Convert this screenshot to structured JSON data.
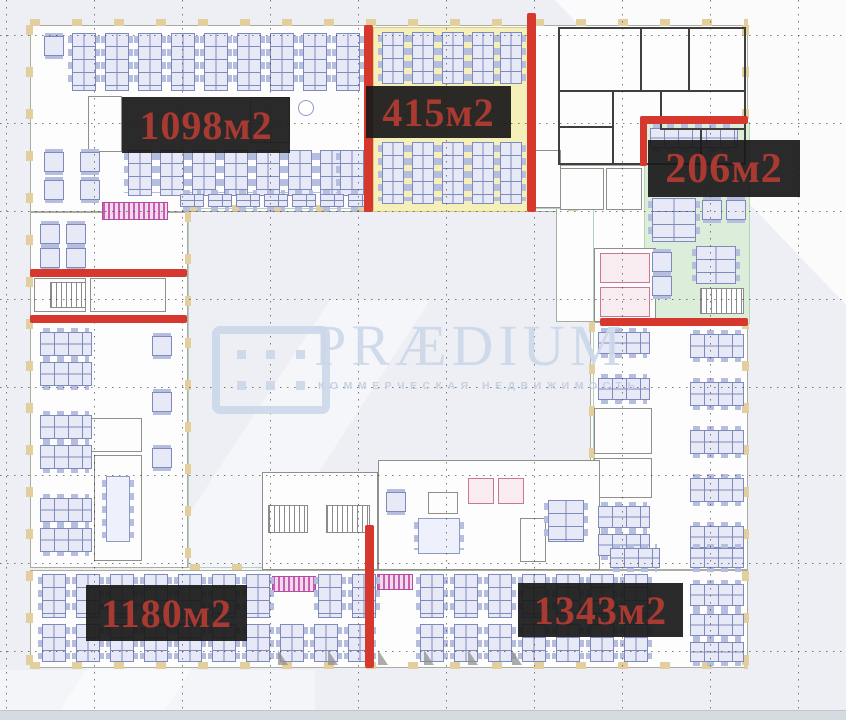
{
  "page": {
    "background": "#edeff4",
    "type": "office-floor-plan"
  },
  "watermark": {
    "brand": "PRÆDIUM",
    "subtitle": "КОММЕРЧЕСКАЯ НЕДВИЖИМОСТЬ",
    "color": "#ccd8e9",
    "logo": "praedium-dots-grid-logo"
  },
  "area_labels": [
    {
      "id": "area-1098",
      "text": "1098м2"
    },
    {
      "id": "area-415",
      "text": "415м2"
    },
    {
      "id": "area-206",
      "text": "206м2"
    },
    {
      "id": "area-1180",
      "text": "1180м2"
    },
    {
      "id": "area-1343",
      "text": "1343м2"
    }
  ],
  "zones": [
    {
      "id": "zone-415",
      "color": "#f5efba",
      "meaning": "highlighted area 415м2"
    },
    {
      "id": "zone-206",
      "color": "#dcedd9",
      "meaning": "highlighted area 206м2"
    }
  ],
  "colors": {
    "label_background": "#1d1d1d",
    "label_text": "#a93a31",
    "divider_red": "#d6382e",
    "desk_fill": "#e7eaf6",
    "desk_border": "#7f8abc",
    "wall_dark": "#3f3f3f",
    "column_tan": "#e3cf9e"
  }
}
